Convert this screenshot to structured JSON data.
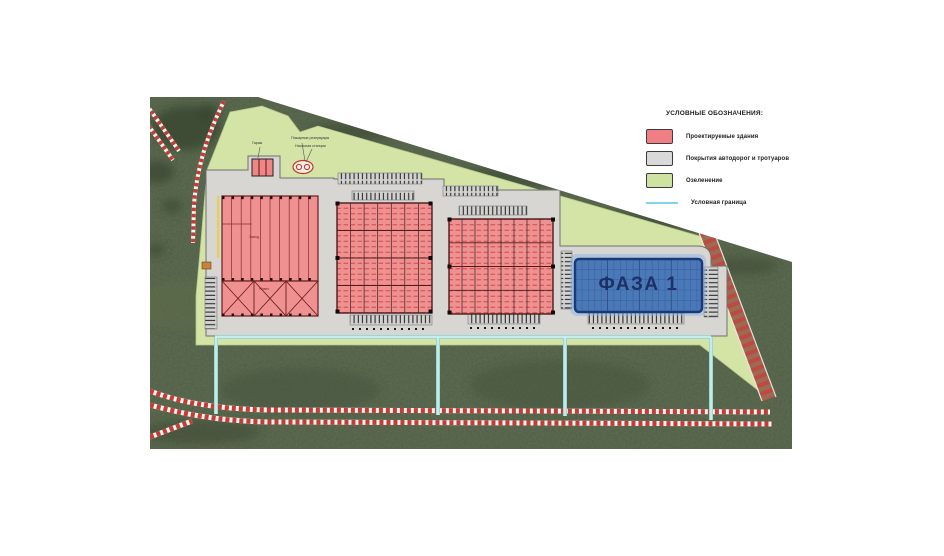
{
  "legend": {
    "title": "УСЛОВНЫЕ ОБОЗНАЧЕНИЯ:",
    "items": [
      {
        "label": "Проектируемые здания",
        "color": "#ef7f84",
        "kind": "swatch"
      },
      {
        "label": "Покрытия автодорог и тротуаров",
        "color": "#d9d9d9",
        "kind": "swatch"
      },
      {
        "label": "Озеленение",
        "color": "#cfe3a1",
        "kind": "swatch"
      },
      {
        "label": "Условная граница",
        "color": "#7fd6e8",
        "kind": "line"
      }
    ]
  },
  "plan": {
    "phase_label": "ФАЗА 1",
    "building_labels": {
      "factory": "Завод",
      "canopy": "Навес"
    },
    "annotations": {
      "garage": "Гараж",
      "fire_reservoirs": "Пожарные резервуары",
      "pump_station": "Насосная станция"
    }
  },
  "colors": {
    "projected_building": "#ef7f84",
    "pavement": "#d9d9d9",
    "greenery": "#cfe3a1",
    "boundary_line": "#7fd6e8",
    "phase_building_fill": "#4b79b7",
    "phase_building_border": "#18397a",
    "field_green": "#4f5d45",
    "road_stripe_red": "#c63b35"
  }
}
